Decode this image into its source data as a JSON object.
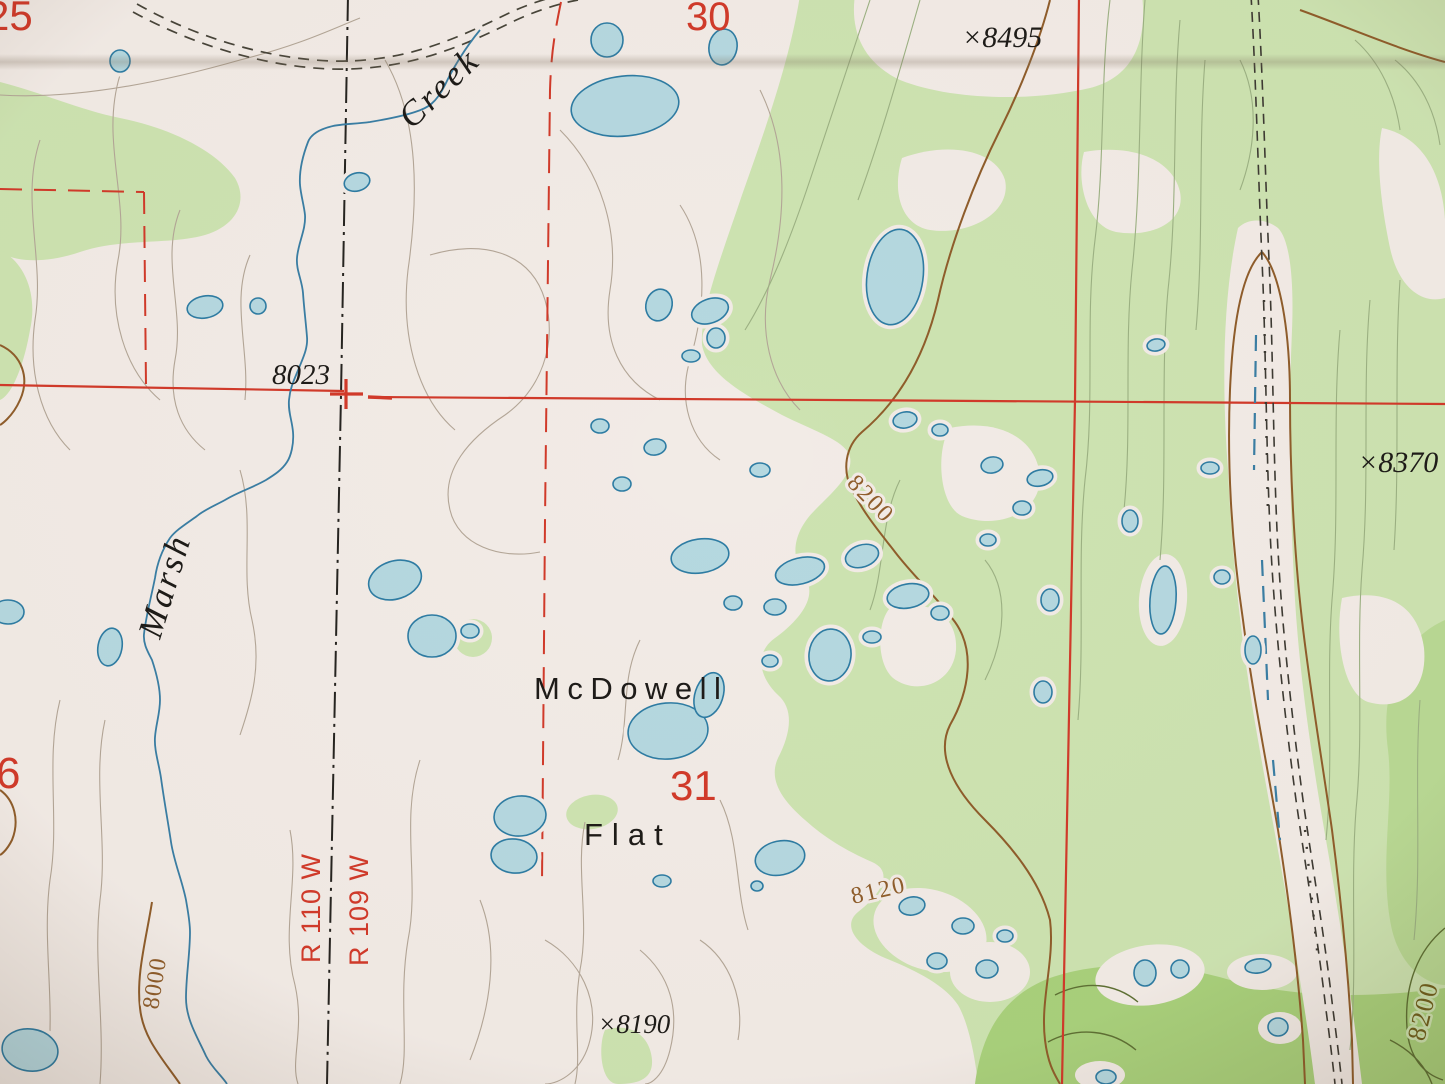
{
  "map": {
    "place_labels": {
      "marsh": "Marsh",
      "creek": "Creek",
      "mcdowell": "McDowell",
      "flat": "Flat"
    },
    "section_numbers": {
      "s25": "25",
      "s30": "30",
      "s31": "31",
      "s36": "6"
    },
    "spot_elevations": {
      "e8495": "×8495",
      "e8370": "×8370",
      "e8190": "×8190",
      "e8023": "8023"
    },
    "contour_labels": {
      "c8200a": "8200",
      "c8120": "8120",
      "c8000": "8000",
      "c8200b": "8200"
    },
    "range_labels": {
      "r110w": "R 110 W",
      "r109w": "R 109 W"
    },
    "colors": {
      "paper": "#f2ebe6",
      "woodland": "#cde3b1",
      "woodland_bright": "#a9d17c",
      "water_fill": "#b5d8e0",
      "water_outline": "#2e7ca3",
      "contour_intermediate": "#b3a697",
      "contour_index": "#8f5d2b",
      "section_line_red": "#d13a2a",
      "label_black": "#1d1b18"
    }
  }
}
